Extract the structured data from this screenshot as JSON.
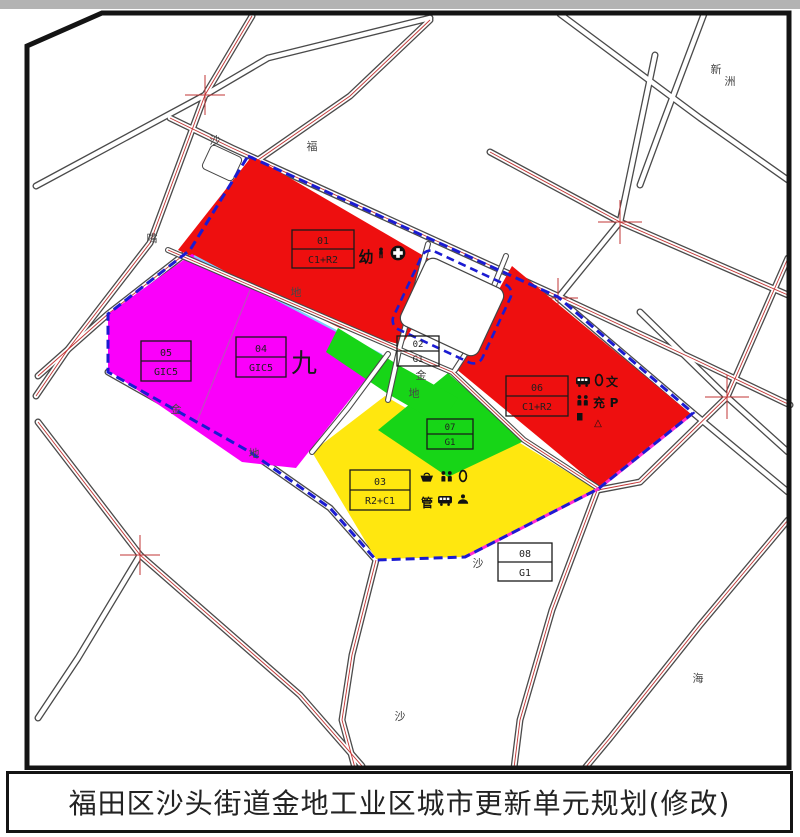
{
  "title_bar": {
    "text": "福田区沙头街道金地工业区城市更新单元规划(修改)"
  },
  "zones": [
    {
      "id": "01",
      "code": "C1+R2",
      "color": "#ee0f0f"
    },
    {
      "id": "02",
      "code": "G1",
      "color": "#17d517"
    },
    {
      "id": "03",
      "code": "R2+C1",
      "color": "#ffe70f"
    },
    {
      "id": "04",
      "code": "GIC5",
      "color": "#fa00fa"
    },
    {
      "id": "05",
      "code": "GIC5",
      "color": "#fa00fa"
    },
    {
      "id": "06",
      "code": "C1+R2",
      "color": "#ee0f0f"
    },
    {
      "id": "07",
      "code": "G1",
      "color": "#17d517"
    },
    {
      "id": "08",
      "code": "G1",
      "color": "#ffffff"
    }
  ],
  "annotations": {
    "nine": "九",
    "kindergarten": "幼",
    "culture": "文",
    "charging": "充",
    "parking": "P",
    "management": "管",
    "triangle": "△"
  },
  "road_labels": [
    {
      "text": "沙"
    },
    {
      "text": "嘴"
    },
    {
      "text": "福"
    },
    {
      "text": "地"
    },
    {
      "text": "金"
    },
    {
      "text": "地"
    },
    {
      "text": "金"
    },
    {
      "text": "地"
    },
    {
      "text": "沙"
    },
    {
      "text": "沙"
    },
    {
      "text": "新"
    },
    {
      "text": "洲"
    },
    {
      "text": "海"
    }
  ],
  "boundary_color": "#1b1bd2"
}
